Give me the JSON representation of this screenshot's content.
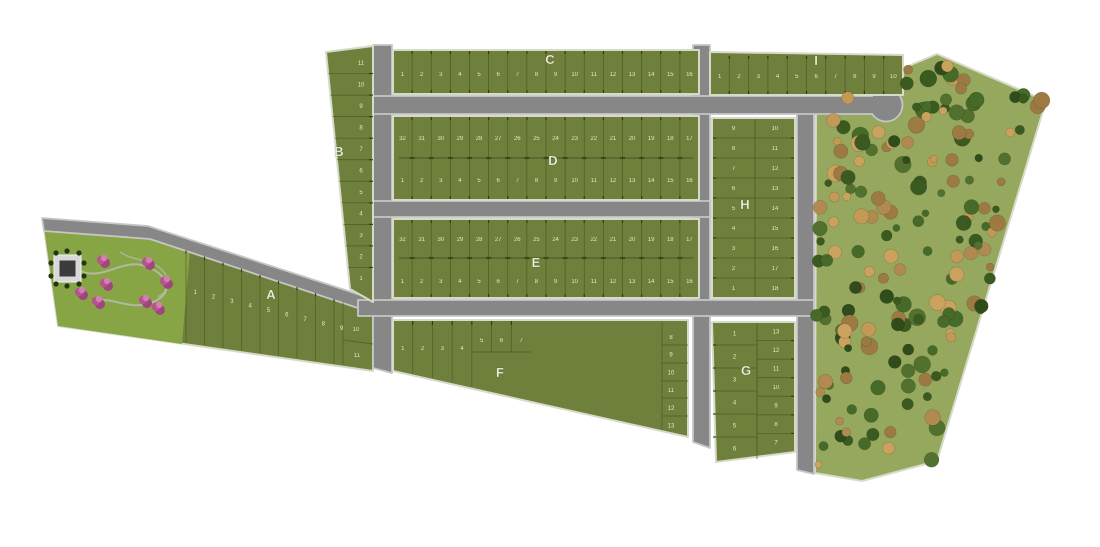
{
  "map": {
    "type": "residential subdivision site plan",
    "blocks": {
      "A": {
        "label": "A",
        "lots": [
          "1",
          "2",
          "3",
          "4",
          "5",
          "6",
          "7",
          "8",
          "9",
          "10",
          "11"
        ]
      },
      "B": {
        "label": "B",
        "lots_top_to_bottom": [
          "11",
          "10",
          "9",
          "8",
          "7",
          "6",
          "5",
          "4",
          "3",
          "2",
          "1"
        ]
      },
      "C": {
        "label": "C",
        "lots_left_to_right": [
          "1",
          "2",
          "3",
          "4",
          "5",
          "6",
          "7",
          "8",
          "9",
          "10",
          "11",
          "12",
          "13",
          "14",
          "15",
          "16"
        ]
      },
      "D": {
        "label": "D",
        "row_top_left_to_right": [
          "32",
          "31",
          "30",
          "29",
          "28",
          "27",
          "26",
          "25",
          "24",
          "23",
          "22",
          "21",
          "20",
          "19",
          "18",
          "17"
        ],
        "row_bottom_left_to_right": [
          "1",
          "2",
          "3",
          "4",
          "5",
          "6",
          "7",
          "8",
          "9",
          "10",
          "11",
          "12",
          "13",
          "14",
          "15",
          "16"
        ]
      },
      "E": {
        "label": "E",
        "row_top_left_to_right": [
          "32",
          "31",
          "30",
          "29",
          "28",
          "27",
          "26",
          "25",
          "24",
          "23",
          "22",
          "21",
          "20",
          "19",
          "18",
          "17"
        ],
        "row_bottom_left_to_right": [
          "1",
          "2",
          "3",
          "4",
          "5",
          "6",
          "7",
          "8",
          "9",
          "10",
          "11",
          "12",
          "13",
          "14",
          "15",
          "16"
        ]
      },
      "F": {
        "label": "F",
        "row_top_left_to_right": [
          "1",
          "2",
          "3",
          "4",
          "5",
          "6",
          "7"
        ],
        "column_right_top_to_bottom": [
          "8",
          "9",
          "10",
          "11",
          "12",
          "13"
        ]
      },
      "G": {
        "label": "G",
        "column_left_top_to_bottom": [
          "1",
          "2",
          "3",
          "4",
          "5",
          "6"
        ],
        "column_right_top_to_bottom": [
          "13",
          "12",
          "11",
          "10",
          "9",
          "8",
          "7"
        ]
      },
      "H": {
        "label": "H",
        "column_left_top_to_bottom": [
          "9",
          "8",
          "7",
          "6",
          "5",
          "4",
          "3",
          "2",
          "1"
        ],
        "column_right_top_to_bottom": [
          "10",
          "11",
          "12",
          "13",
          "14",
          "15",
          "16",
          "17",
          "18"
        ]
      },
      "I": {
        "label": "I",
        "lots_left_to_right": [
          "1",
          "2",
          "3",
          "4",
          "5",
          "6",
          "7",
          "8",
          "9",
          "10"
        ]
      }
    },
    "features": {
      "forest": "wooded conservation area",
      "park": "landscaped park with flowering trees, walking paths and pavilion",
      "cul_de_sac": "street turnaround bulb",
      "roads": "internal paved streets"
    },
    "colors": {
      "background": "#ffffff",
      "lot_green": "#6f7f3c",
      "park_green": "#88a546",
      "forest_green": "#95a85e",
      "road_gray": "#878787",
      "curb_gray": "#c6c6c6",
      "sidewalk": "#d7dac9",
      "lot_line": "#49571f",
      "tick_dark": "#26300f",
      "tree_dark_green": "#3e5c24",
      "tree_tan": "#b08a50",
      "flower_pink": "#b5548f",
      "label_text": "#f3f6e2",
      "number_text": "#e9edd2",
      "path_gray": "#b6bda6"
    }
  }
}
